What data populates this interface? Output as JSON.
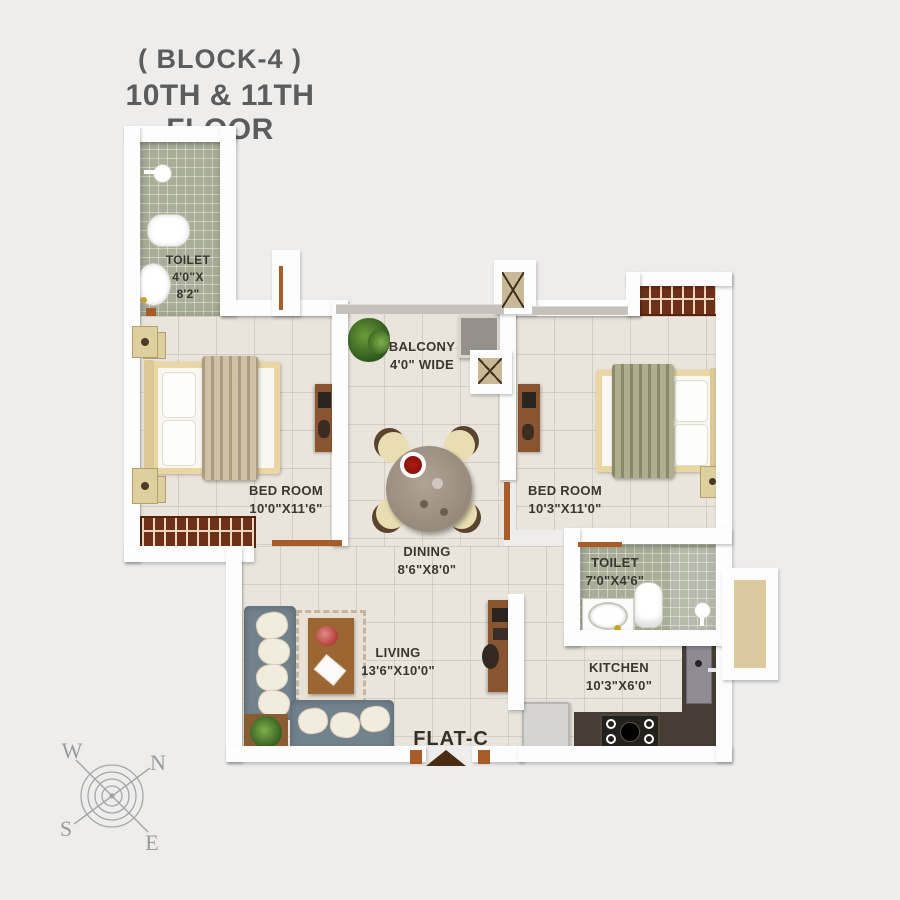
{
  "title": {
    "line1": "( BLOCK-4 )",
    "line2": "10TH & 11TH FLOOR"
  },
  "rooms": {
    "toilet1": {
      "name": "TOILET",
      "dim_line1": "4'0\"X",
      "dim_line2": "8'2\""
    },
    "bedroom1": {
      "name": "BED ROOM",
      "dim": "10'0\"X11'6\""
    },
    "balcony": {
      "name": "BALCONY",
      "dim": "4'0\" WIDE"
    },
    "bedroom2": {
      "name": "BED ROOM",
      "dim": "10'3\"X11'0\""
    },
    "dining": {
      "name": "DINING",
      "dim": "8'6\"X8'0\""
    },
    "toilet2": {
      "name": "TOILET",
      "dim": "7'0\"X4'6\""
    },
    "living": {
      "name": "LIVING",
      "dim": "13'6\"X10'0\""
    },
    "kitchen": {
      "name": "KITCHEN",
      "dim": "10'3\"X6'0\""
    }
  },
  "flat_label": "FLAT-C",
  "compass": {
    "north": "N",
    "south": "S",
    "east": "E",
    "west": "W"
  },
  "colors": {
    "background": "#eeedec",
    "wall": "#fdfdfd",
    "floor_tile": "#e9e4dc",
    "toilet_tile": "#a9ae98",
    "dark_wood": "#8a5430",
    "door": "#a85c28",
    "sofa": "#72828c",
    "counter": "#463d33",
    "title_text": "#5c5c5c",
    "label_text": "#3a3630"
  }
}
